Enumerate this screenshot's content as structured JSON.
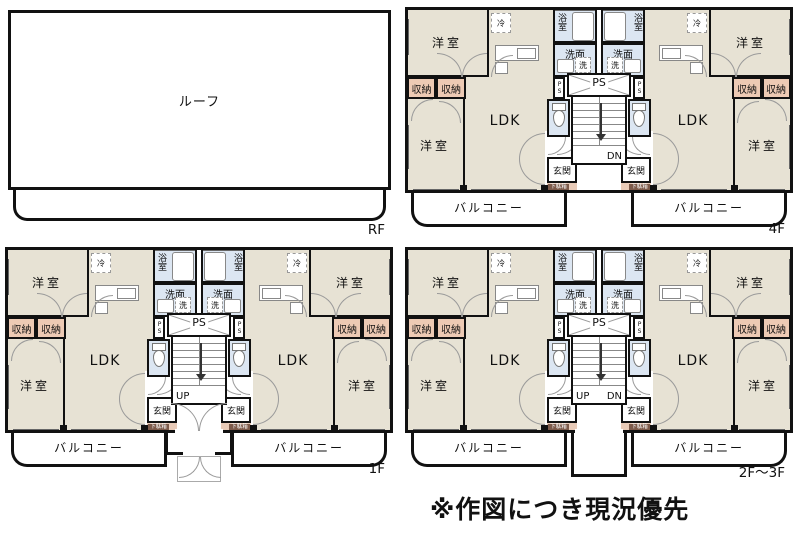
{
  "note": "※作図につき現況優先",
  "room_labels": {
    "roof": "ルーフ",
    "room": "洋室",
    "storage": "収納",
    "ldk": "LDK",
    "fridge": "冷",
    "bath": "浴室",
    "wash": "洗面",
    "washer": "洗",
    "ps": "PS",
    "entrance": "玄関",
    "shoebox": "下駄箱",
    "balcony": "バルコニー"
  },
  "floor_plans": {
    "rf": {
      "tag": "RF"
    },
    "f4": {
      "tag": "4F",
      "stairs": {
        "dn": "DN"
      }
    },
    "f1": {
      "tag": "1F",
      "stairs": {
        "up": "UP"
      }
    },
    "f23": {
      "tag": "2F〜3F",
      "stairs": {
        "up": "UP",
        "dn": "DN"
      }
    }
  },
  "colors": {
    "room_fill": "#e7e2d4",
    "storage_fill": "#edcab4",
    "wet_area_fill": "#dce6f2",
    "shoe_strip_fill": "#e9cbb8",
    "shoe_label_fill": "#7d5a4a",
    "wall": "#111111"
  }
}
